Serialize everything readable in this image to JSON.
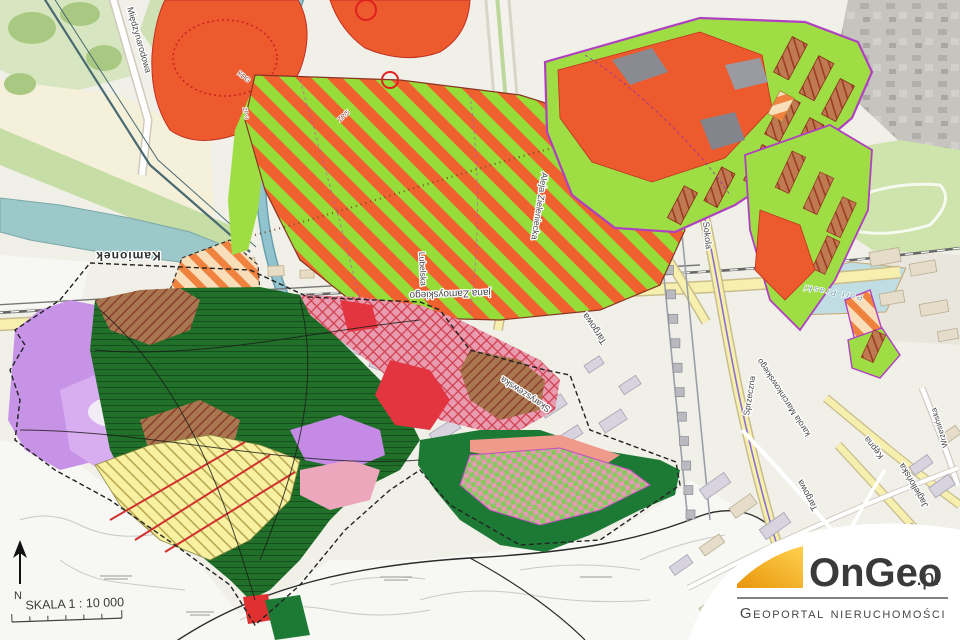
{
  "map": {
    "scale_label": "SKALA 1 : 10 000",
    "north_label": "N",
    "streets": {
      "miedzynarodowa": "Międzynarodowa",
      "kamionek": "Kamionek",
      "zamoyskiego": "jana Zamoyskiego",
      "targowa_n": "Targowa",
      "targowa_s": "Targowa",
      "lubelska": "Lubelska",
      "sokola": "Sokola",
      "zieleniecka": "Aleja Zieleniecka",
      "skaryszewska": "Skaryszewska",
      "sprzeczna": "Sprzeczna",
      "marcinkowskiego": "karola Marcinkowskiego",
      "kepna": "Kępna",
      "jagiellonska": "Jagiellońska",
      "wrzesinska": "Wrzesińska"
    },
    "water_labels": {
      "port_praski": "Port Praski"
    },
    "zone_labels": {
      "kdg": "KDG",
      "zp5": "ZP/5",
      "zp3": "ZP 3"
    }
  },
  "logo": {
    "brand": "OnGeo",
    "tld": ".pl",
    "subtitle": "Geoportal nieruchomości"
  },
  "colors": {
    "zone_orange": "#ec5a2d",
    "zone_lime": "#9edd44",
    "plan_dark_green": "#20702a",
    "plan_purple": "#c793e6",
    "logo_accent": "#f2a71b",
    "road_yellow": "#f6efae",
    "water": "#9cc8c9"
  }
}
